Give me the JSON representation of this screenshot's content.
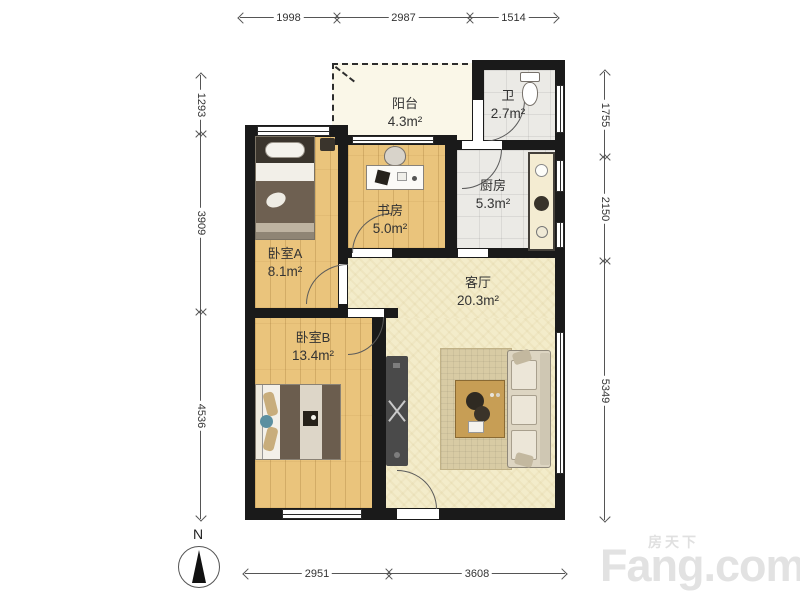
{
  "rooms": [
    {
      "id": "balcony",
      "name": "阳台",
      "area": "4.3m²"
    },
    {
      "id": "bathroom",
      "name": "卫",
      "area": "2.7m²"
    },
    {
      "id": "kitchen",
      "name": "厨房",
      "area": "5.3m²"
    },
    {
      "id": "study",
      "name": "书房",
      "area": "5.0m²"
    },
    {
      "id": "bedroomA",
      "name": "卧室A",
      "area": "8.1m²"
    },
    {
      "id": "bedroomB",
      "name": "卧室B",
      "area": "13.4m²"
    },
    {
      "id": "living",
      "name": "客厅",
      "area": "20.3m²"
    }
  ],
  "dimensions": {
    "top": [
      "1998",
      "2987",
      "1514"
    ],
    "bottom": [
      "2951",
      "3608"
    ],
    "left": [
      "1293",
      "3909",
      "4536"
    ],
    "right": [
      "1755",
      "2150",
      "5349"
    ]
  },
  "compass": {
    "label": "N"
  },
  "watermark": {
    "cn": "房天下",
    "en": "Fang.com"
  },
  "colors": {
    "wall": "#1a1a1a",
    "wood": "#eac47c",
    "tile": "#ebeae6",
    "living": "#f3ecca",
    "balcony": "#faf7e8"
  }
}
